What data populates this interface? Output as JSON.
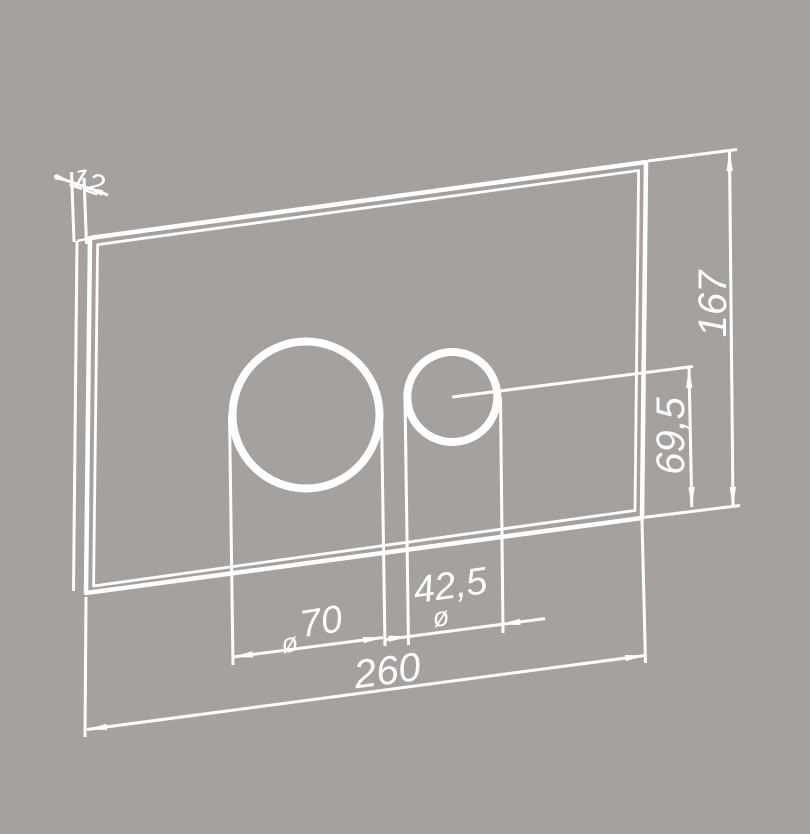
{
  "page": {
    "background_color": "#a5a19f",
    "line_color": "#ffffff"
  },
  "drawing": {
    "dimensions": {
      "thickness": {
        "label": "12"
      },
      "plate_height": {
        "label": "167"
      },
      "button_center_to_bottom": {
        "label": "69,5"
      },
      "large_button_diameter": {
        "symbol": "ø",
        "value": "70"
      },
      "small_button_diameter": {
        "value": "42,5",
        "symbol": "ø"
      },
      "plate_width": {
        "label": "260"
      }
    }
  }
}
